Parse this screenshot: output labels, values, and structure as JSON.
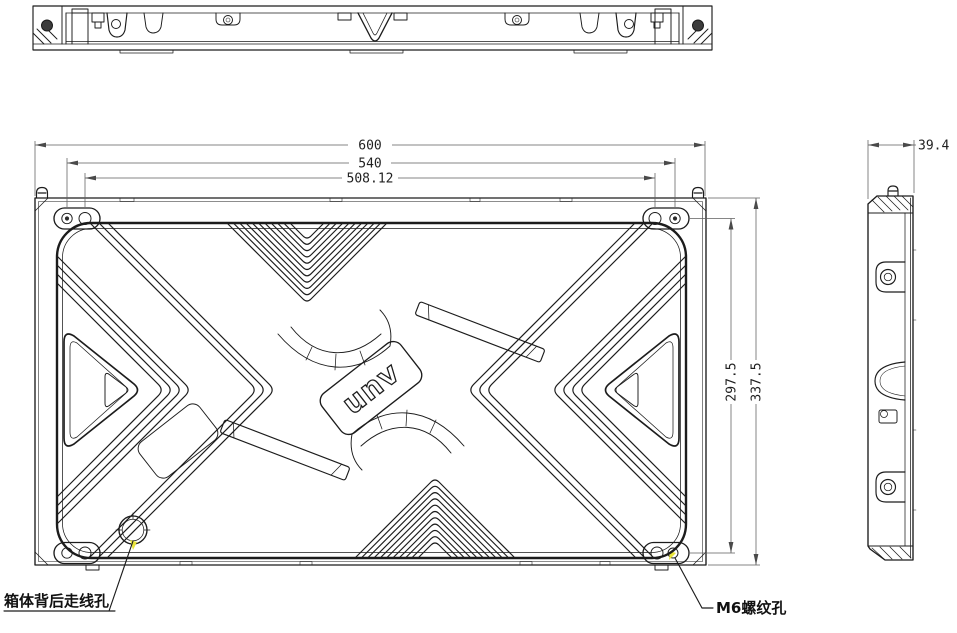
{
  "drawing": {
    "background": "#ffffff",
    "line_color": "#1c1c1c",
    "dim_color": "#5f5f5f",
    "highlight_color": "#e9e43b",
    "logo_text": "unv",
    "dimensions": {
      "width_total": "600",
      "width_mount": "540",
      "width_inner": "508.12",
      "height_mount": "297.5",
      "height_total": "337.5",
      "depth": "39.4"
    },
    "callouts": {
      "cable_hole": "箱体背后走线孔",
      "m6_hole": "M6螺纹孔"
    }
  }
}
